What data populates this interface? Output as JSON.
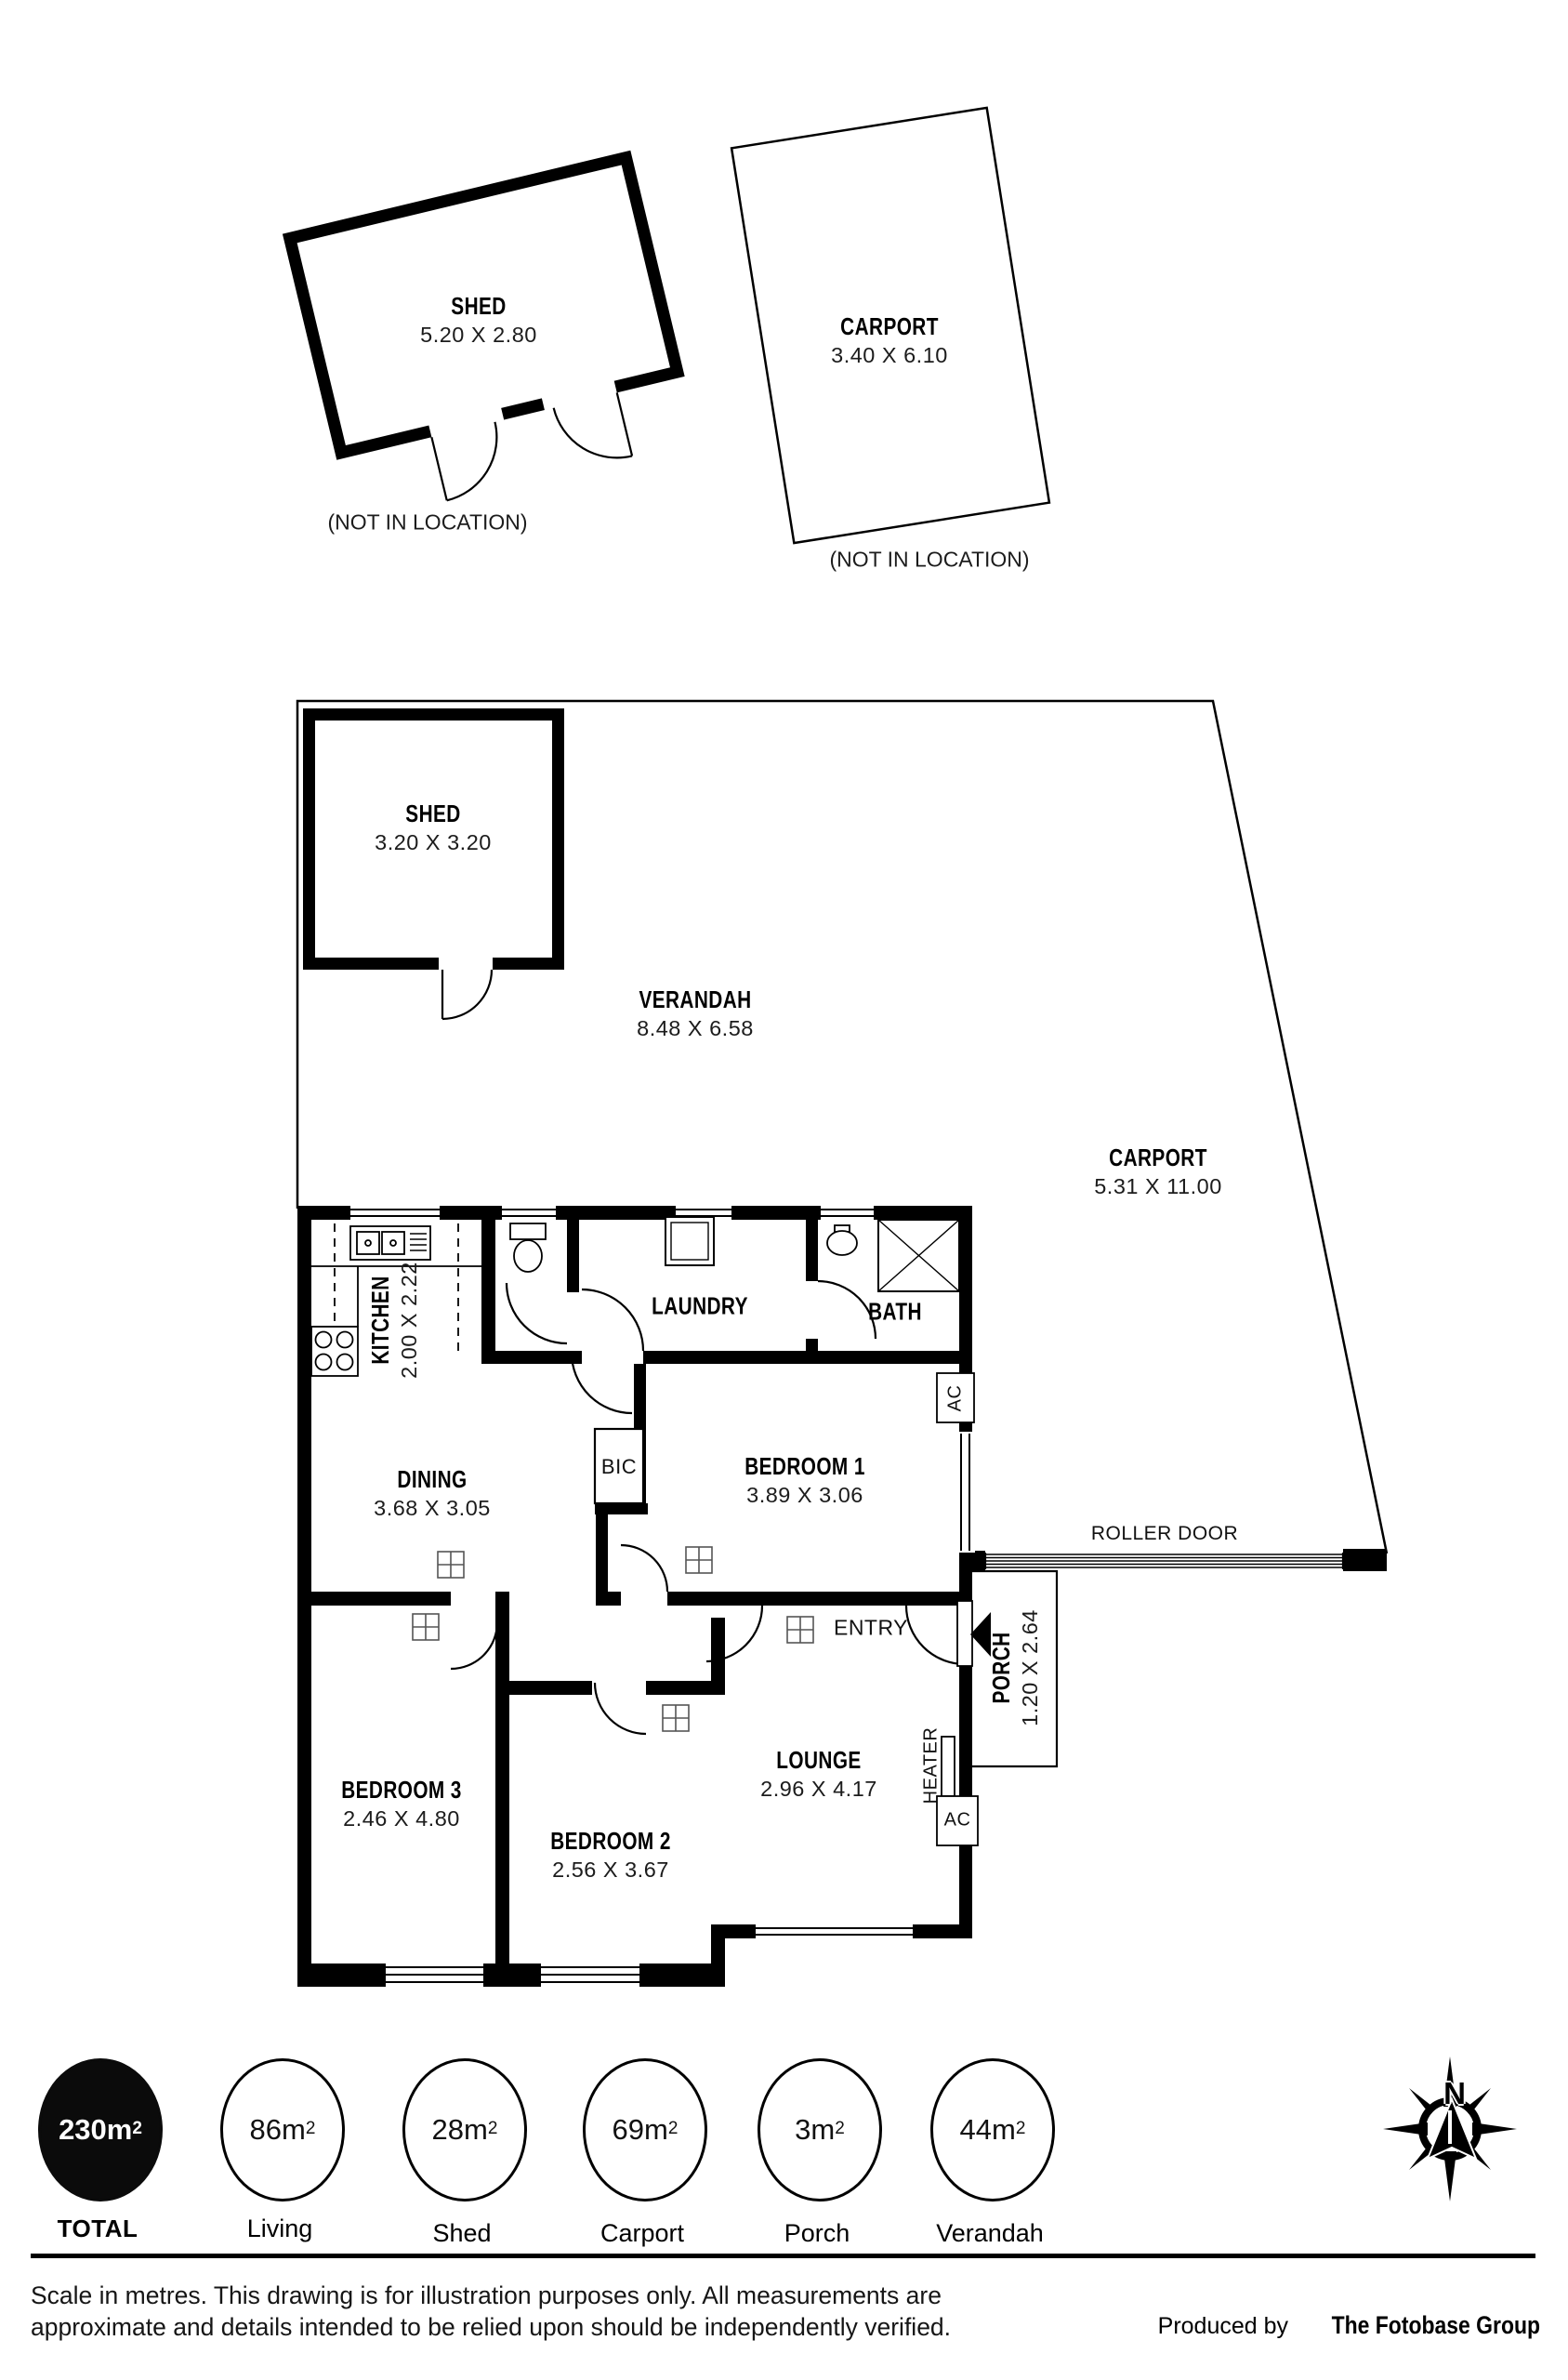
{
  "outbuildings": {
    "shed1": {
      "name": "SHED",
      "dims": "5.20 X 2.80",
      "note": "(NOT IN LOCATION)"
    },
    "carport1": {
      "name": "CARPORT",
      "dims": "3.40 X 6.10",
      "note": "(NOT IN LOCATION)"
    }
  },
  "site": {
    "shed2": {
      "name": "SHED",
      "dims": "3.20 X 3.20"
    },
    "verandah": {
      "name": "VERANDAH",
      "dims": "8.48 X 6.58"
    },
    "carport2": {
      "name": "CARPORT",
      "dims": "5.31 X 11.00"
    },
    "roller_door": "ROLLER DOOR"
  },
  "rooms": {
    "kitchen": {
      "name": "KITCHEN",
      "dims": "2.00 X 2.22"
    },
    "laundry": {
      "name": "LAUNDRY"
    },
    "bath": {
      "name": "BATH"
    },
    "dining": {
      "name": "DINING",
      "dims": "3.68 X 3.05"
    },
    "bedroom1": {
      "name": "BEDROOM 1",
      "dims": "3.89 X 3.06"
    },
    "bedroom2": {
      "name": "BEDROOM 2",
      "dims": "2.56 X 3.67"
    },
    "bedroom3": {
      "name": "BEDROOM 3",
      "dims": "2.46 X 4.80"
    },
    "lounge": {
      "name": "LOUNGE",
      "dims": "2.96 X 4.17"
    },
    "porch": {
      "name": "PORCH",
      "dims": "1.20 X 2.64"
    },
    "bic": "BIC",
    "entry": "ENTRY"
  },
  "fixtures": {
    "ac": "AC",
    "heater": "HEATER"
  },
  "legend": {
    "items": [
      {
        "value": "230m",
        "sup": "2",
        "label": "TOTAL",
        "filled": true
      },
      {
        "value": "86m",
        "sup": "2",
        "label": "Living",
        "filled": false
      },
      {
        "value": "28m",
        "sup": "2",
        "label": "Shed",
        "filled": false
      },
      {
        "value": "69m",
        "sup": "2",
        "label": "Carport",
        "filled": false
      },
      {
        "value": "3m",
        "sup": "2",
        "label": "Porch",
        "filled": false
      },
      {
        "value": "44m",
        "sup": "2",
        "label": "Verandah",
        "filled": false
      }
    ]
  },
  "compass": {
    "north": "N"
  },
  "footer": {
    "line1": "Scale in metres. This drawing is for illustration purposes only. All measurements are",
    "line2": "approximate and details intended to be relied upon should be independently verified.",
    "credit_prefix": "Produced by ",
    "credit_name": "The Fotobase Group"
  }
}
